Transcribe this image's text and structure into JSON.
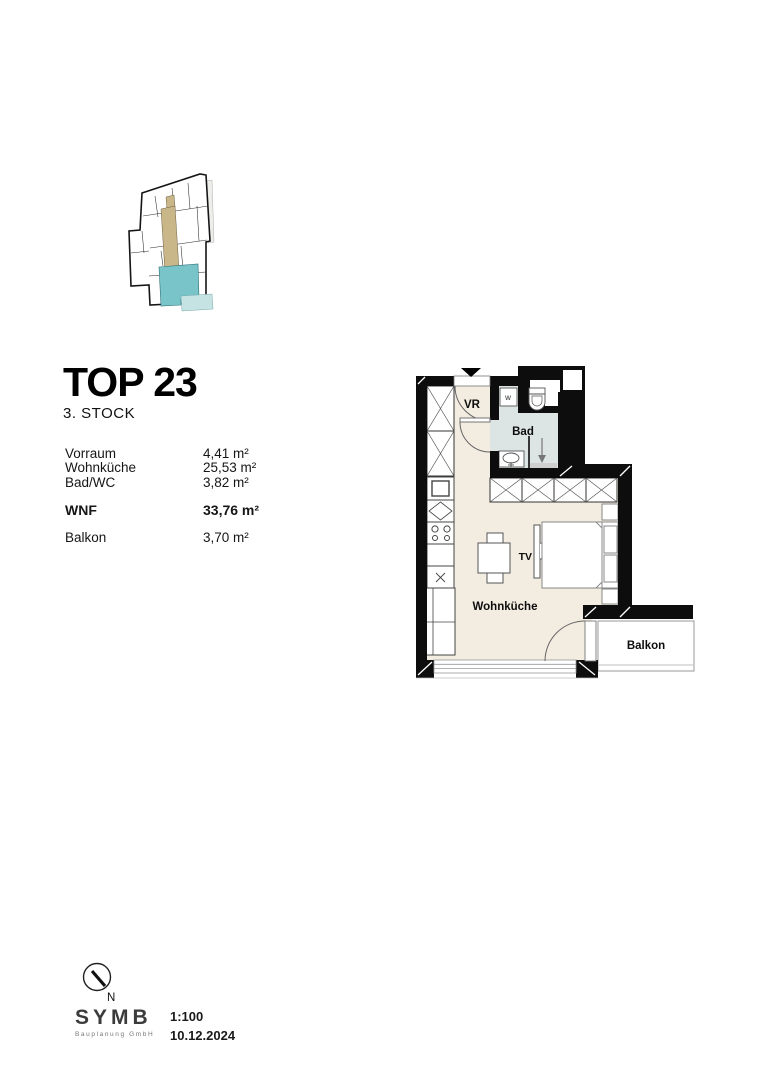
{
  "header": {
    "title": "TOP 23",
    "floor": "3. STOCK"
  },
  "areas": {
    "rooms": [
      {
        "label": "Vorraum",
        "value": "4,41 m²"
      },
      {
        "label": "Wohnküche",
        "value": "25,53 m²"
      },
      {
        "label": "Bad/WC",
        "value": "3,82 m²"
      }
    ],
    "total": {
      "label": "WNF",
      "value": "33,76 m²"
    },
    "extra": {
      "label": "Balkon",
      "value": "3,70 m²"
    }
  },
  "plan": {
    "labels": {
      "vorraum": "VR",
      "bad": "Bad",
      "living": "Wohnküche",
      "balcony": "Balkon",
      "tv": "TV",
      "washer": "w"
    }
  },
  "footer": {
    "compass_label": "N",
    "logo": "SYMB",
    "logo_sub": "Bauplanung GmbH",
    "scale": "1:100",
    "date": "10.12.2024"
  },
  "colors": {
    "floor": "#f2ece1",
    "bathroom_floor": "#dce5e4",
    "unit_highlight": "#79c4c8",
    "balcony_highlight": "#c6e3e3",
    "corridor_highlight": "#c9b78a",
    "wall": "#0d0d0d"
  }
}
